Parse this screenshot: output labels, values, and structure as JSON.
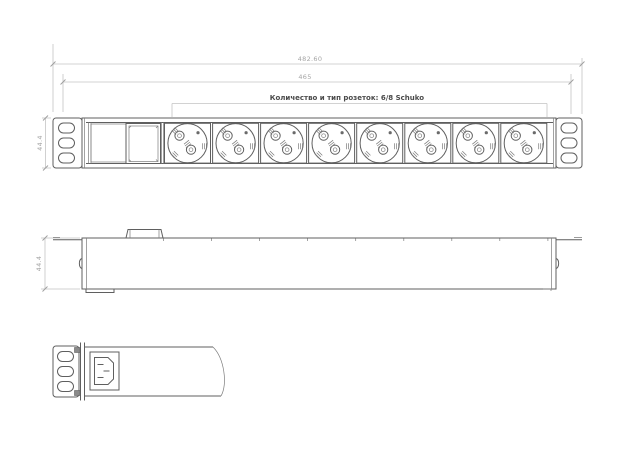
{
  "drawing": {
    "type": "technical-drawing",
    "subject": "1U rack-mount PDU with Schuko sockets",
    "colors": {
      "background": "#ffffff",
      "object_line": "#5f5f5f",
      "dimension_line": "#c4c4c4",
      "dimension_text": "#a5a5a5",
      "label_text": "#4a4a4a"
    },
    "views": {
      "front": {
        "sockets_label": "Количество и тип розеток: 6/8 Schuko",
        "socket_count": 8,
        "dim_overall_width": "482.60",
        "dim_mounting_width": "465",
        "dim_height": "44.4",
        "mounting_holes_per_ear": 3
      },
      "side": {
        "dim_height": "44.4"
      },
      "end": {
        "inlet": "C14-inlet"
      }
    }
  }
}
